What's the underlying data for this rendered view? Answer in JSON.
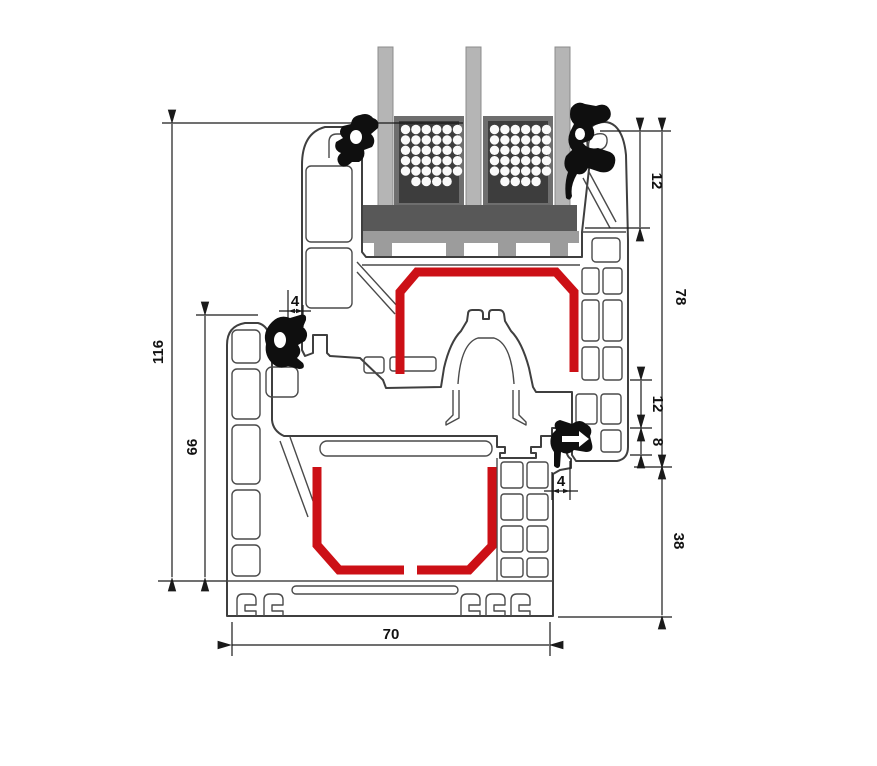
{
  "diagram": {
    "title": "window-profile-cross-section",
    "colors": {
      "steel_reinforcement_red": "#cc1016",
      "gasket_black": "#0f0f0f",
      "glass_gray": "#b5b5b5",
      "spacer_dark": "#3d3d3d",
      "setting_block_gray": "#585858",
      "glazing_bridge_gray": "#9c9c9c",
      "profile_outline": "#3f3f3f"
    },
    "dimensions": {
      "total_height": "116",
      "frame_height": "66",
      "gasket_overlap_top": "4",
      "sash_top_segment": "12",
      "sash_height": "78",
      "rebate_segment_12": "12",
      "rebate_segment_8": "8",
      "gasket_overlap_right": "4",
      "frame_rebate_height": "38",
      "profile_depth": "70"
    }
  }
}
